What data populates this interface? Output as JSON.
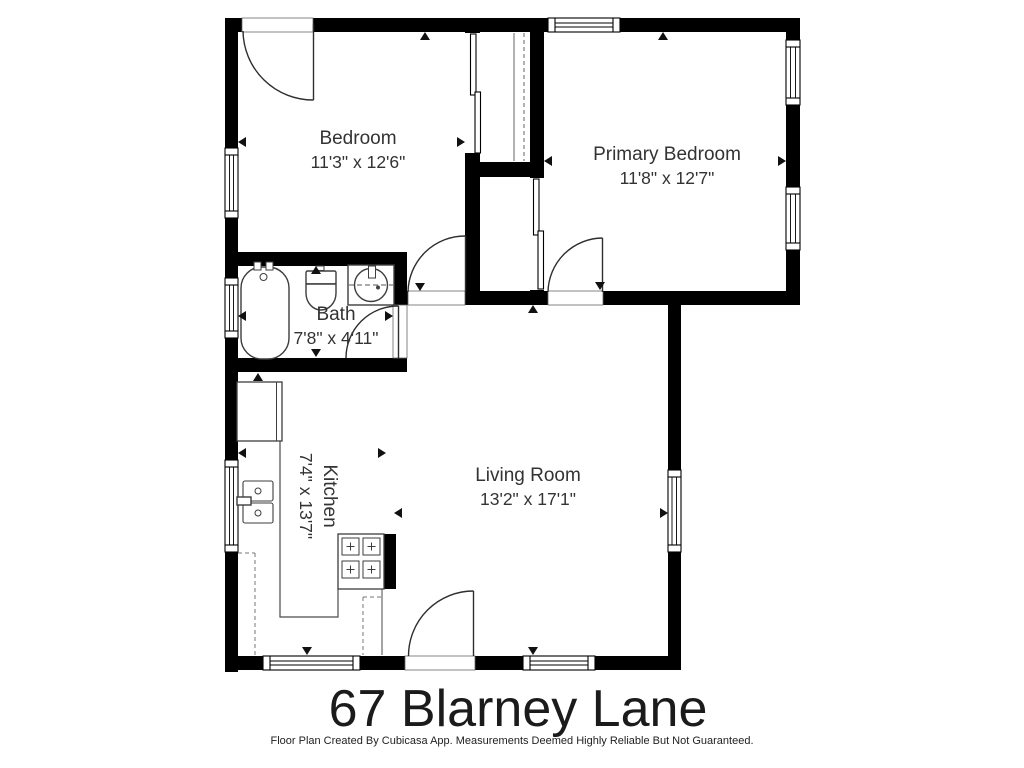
{
  "page": {
    "title": "67 Blarney Lane",
    "disclaimer": "Floor Plan Created By Cubicasa App. Measurements Deemed Highly Reliable But Not Guaranteed."
  },
  "rooms": [
    {
      "name": "Bedroom",
      "dims": "11'3\" x 12'6\""
    },
    {
      "name": "Primary Bedroom",
      "dims": "11'8\" x 12'7\""
    },
    {
      "name": "Bath",
      "dims": "7'8\" x 4'11\""
    },
    {
      "name": "Kitchen",
      "dims": "7'4\" x 13'7\""
    },
    {
      "name": "Living Room",
      "dims": "13'2\" x 17'1\""
    }
  ],
  "colors": {
    "wall": "#000000",
    "background": "#ffffff",
    "label_text": "#333333",
    "title_text": "#1b1b1b"
  }
}
